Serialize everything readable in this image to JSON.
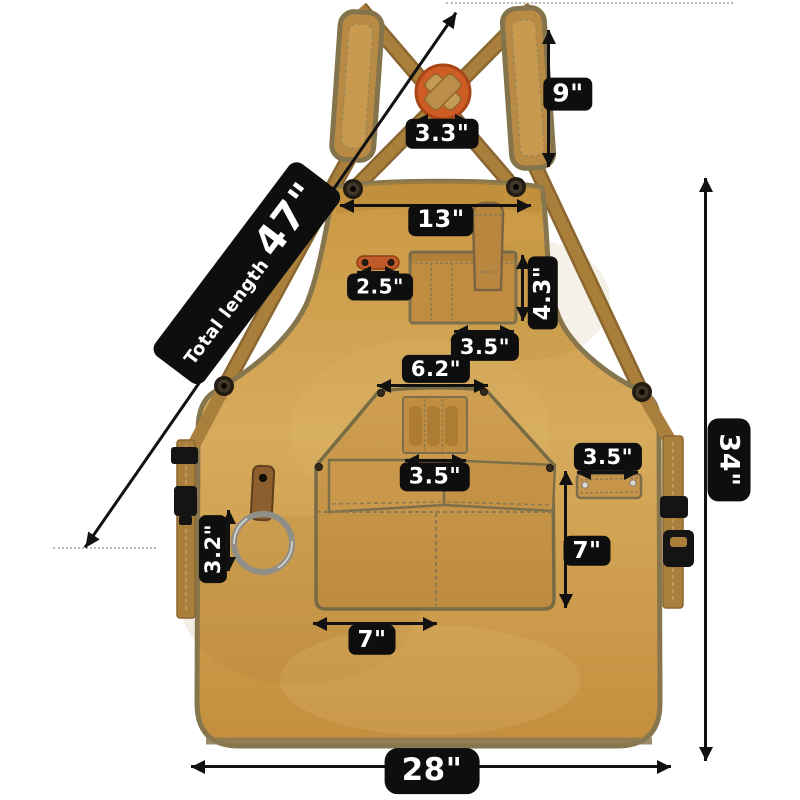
{
  "meta": {
    "description": "Canvas work apron with tool pockets — product dimension diagram",
    "background_color": "#ffffff",
    "label_background": "#0e0e0e",
    "label_text_color": "#ffffff",
    "arrow_color": "#111111",
    "apron_main_color": "#d0a04f",
    "apron_edge_color": "#86764e",
    "strap_color": "#aa7f3c",
    "cross_patch_color": "#cd5c25",
    "hardware_color": "#141414",
    "ring_color": "#8f8f88"
  },
  "dimensions": {
    "total_length_prefix": "Total length",
    "total_length_value": "47\"",
    "back_strap_height": "9\"",
    "strap_cross_width": "3.3\"",
    "bib_top_width": "13\"",
    "leather_patch_width": "2.5\"",
    "chest_pocket_height": "4.3\"",
    "chest_pocket_width": "3.5\"",
    "main_pocket_top_width": "6.2\"",
    "tool_slot_width": "3.5\"",
    "side_loop_width": "3.5\"",
    "tool_ring_height": "3.2\"",
    "main_pocket_height": "7\"",
    "main_pocket_bottom_width": "7\"",
    "apron_length": "34\"",
    "apron_width": "28\""
  }
}
